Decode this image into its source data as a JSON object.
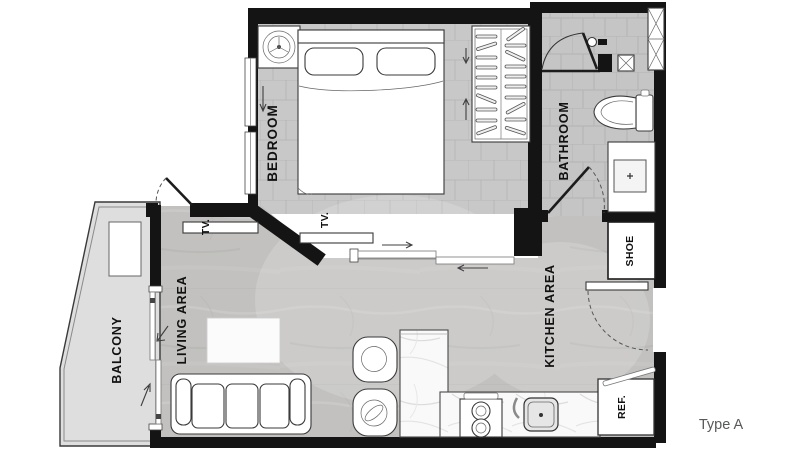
{
  "title": "Type A",
  "rooms": {
    "bedroom": {
      "label": "BEDROOM"
    },
    "bathroom": {
      "label": "BATHROOM"
    },
    "living_area": {
      "label": "LIVING AREA"
    },
    "kitchen_area": {
      "label": "KITCHEN AREA"
    },
    "balcony": {
      "label": "BALCONY"
    }
  },
  "fixtures": {
    "shoe_cabinet": {
      "label": "SHOE"
    },
    "refrigerator": {
      "label": "REF."
    },
    "tv_living": {
      "label": "TV."
    },
    "tv_bedroom": {
      "label": "TV."
    }
  },
  "symbols": [
    "double-bed",
    "pillow",
    "ceiling-fan",
    "wardrobe-hangers",
    "sliding-door",
    "swing-door",
    "door-swing-arc",
    "shower-head",
    "shower-door",
    "floor-drain",
    "toilet",
    "wash-basin",
    "service-shaft",
    "sofa-3-seat",
    "coffee-table",
    "tub-chair",
    "kitchen-island",
    "stove-2-burner",
    "kitchen-sink",
    "balcony-ac-unit",
    "direction-arrow"
  ],
  "colors": {
    "wall": "#141414",
    "label_text": "#111111",
    "title_text": "#58595b",
    "bedroom_floor": "#c8c8c8",
    "living_floor": "#c2c1bf",
    "bathroom_floor": "#c5c5c5",
    "balcony_floor": "#dedede",
    "fixture_fill": "#ffffff"
  }
}
